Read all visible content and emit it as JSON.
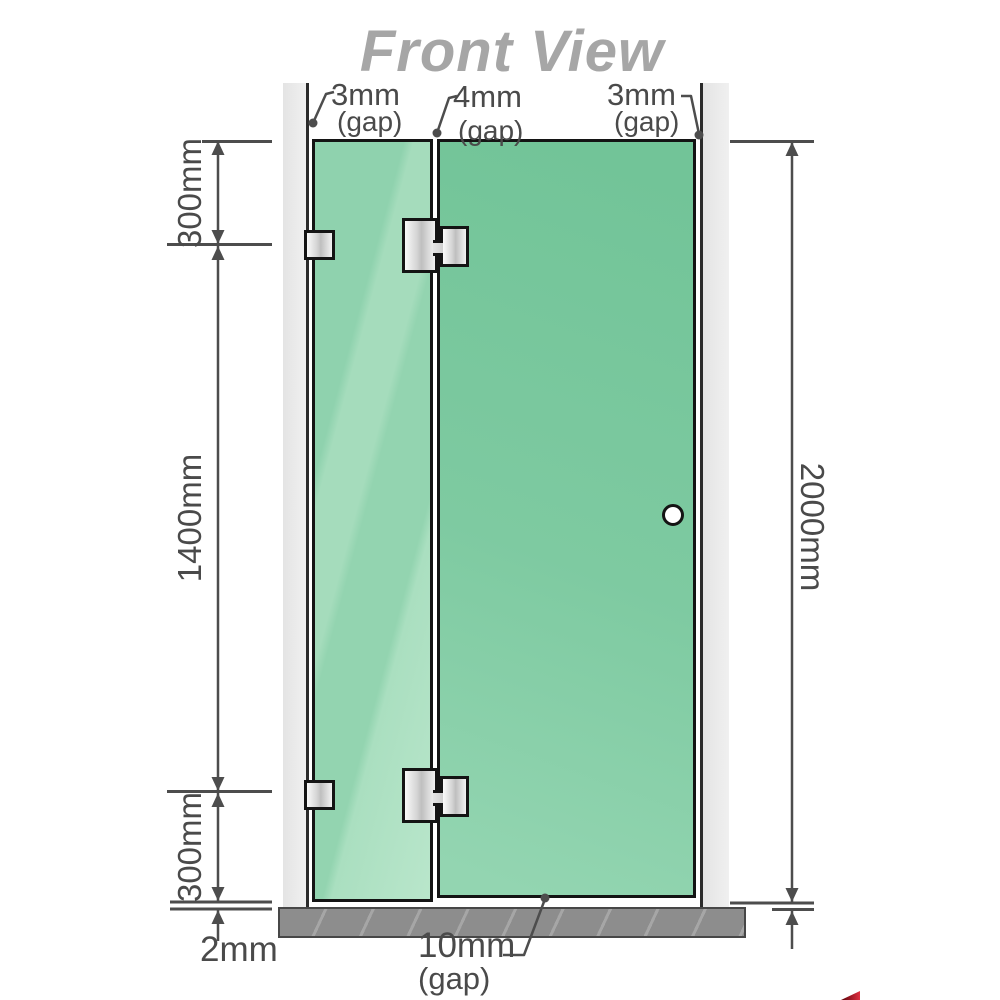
{
  "title": "Front View",
  "top_gap_labels": [
    {
      "value": "3mm",
      "suffix": "(gap)"
    },
    {
      "value": "4mm",
      "suffix": "(gap)"
    },
    {
      "value": "3mm",
      "suffix": "(gap)"
    }
  ],
  "side_dimensions": {
    "left_top": "300mm",
    "left_middle": "1400mm",
    "left_bottom": "300mm",
    "left_floor_gap": "2mm",
    "right_total": "2000mm"
  },
  "bottom_gap_label": {
    "value": "10mm",
    "suffix": "(gap)"
  },
  "colors": {
    "glass_door": "#7ecaa1",
    "glass_fixed": "#9bd6b7",
    "annotation": "#4a4a4a",
    "title_gray": "#a6a6a6",
    "floor_gray": "#8d8d8d",
    "corner_red": "#c20000"
  }
}
